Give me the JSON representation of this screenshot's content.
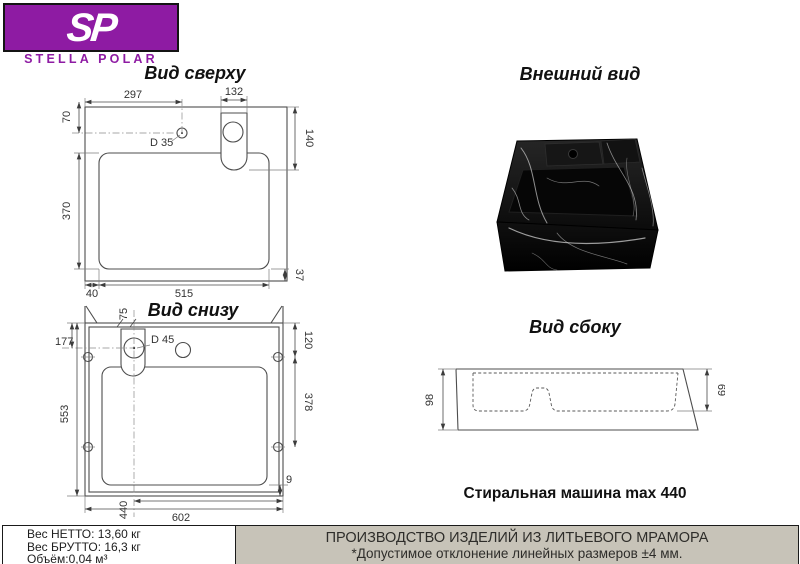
{
  "logo": {
    "sp": "SP",
    "name": "STELLA POLAR"
  },
  "views": {
    "top": {
      "title": "Вид сверху",
      "dims": {
        "d297": "297",
        "d132": "132",
        "d70": "70",
        "d140": "140",
        "d370": "370",
        "d40": "40",
        "d515": "515",
        "d37": "37",
        "d35": "D 35"
      }
    },
    "bottom": {
      "title": "Вид снизу",
      "dims": {
        "d75": "75",
        "d45": "D 45",
        "d177": "177",
        "d553": "553",
        "d120": "120",
        "d378": "378",
        "d9": "9",
        "d440": "440",
        "d602": "602"
      }
    },
    "external": {
      "title": "Внешний вид"
    },
    "side": {
      "title": "Вид сбоку",
      "dims": {
        "d98": "98",
        "d69": "69"
      }
    }
  },
  "notes": {
    "machine": "Стиральная машина max 440"
  },
  "footer": {
    "weights": [
      "Вес НЕТТО: 13,60 кг",
      "Вес БРУТТО: 16,3 кг",
      "Объём:0,04 м³"
    ],
    "production_line1": "ПРОИЗВОДСТВО ИЗДЕЛИЙ ИЗ ЛИТЬЕВОГО МРАМОРА",
    "production_line2": "*Допустимое отклонение линейных размеров ±4 мм."
  },
  "colors": {
    "brand_purple": "#8e1ba3",
    "footer_gray": "#c7c3b8"
  }
}
